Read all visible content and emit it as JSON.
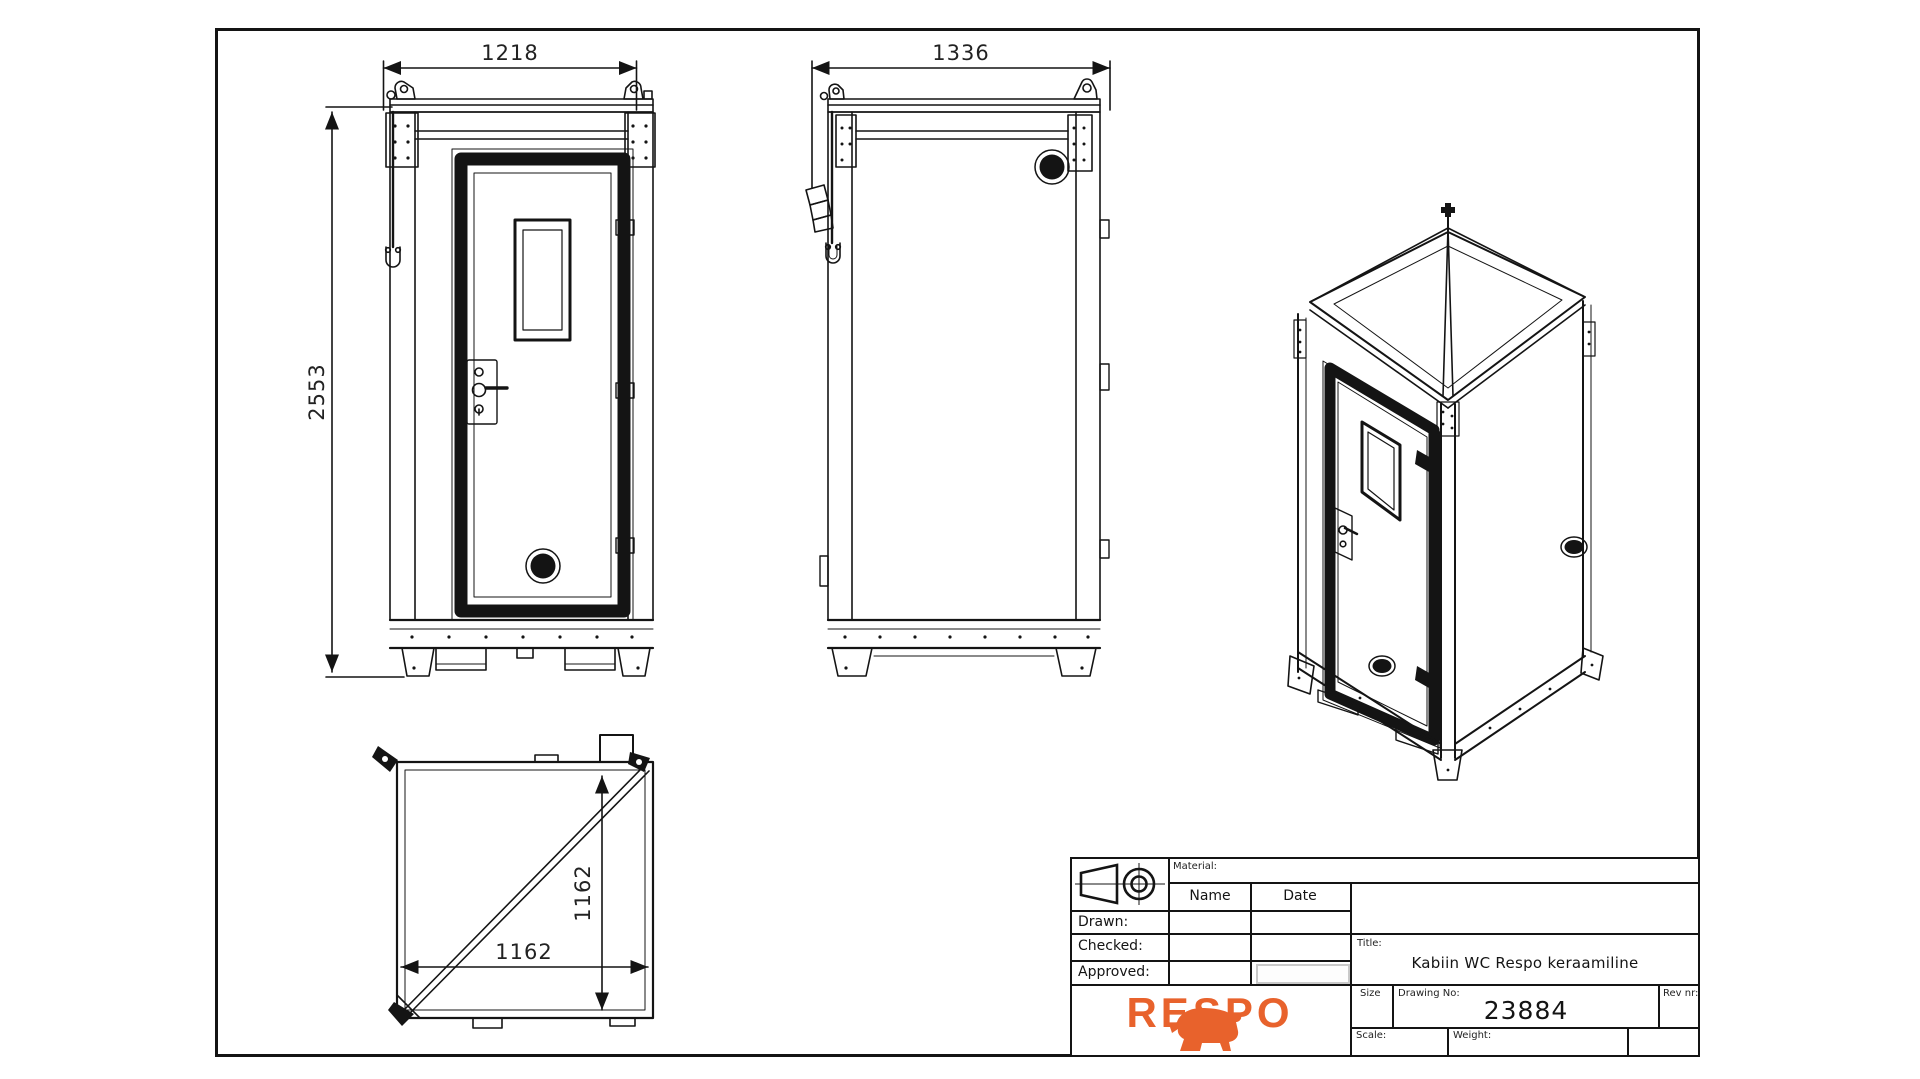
{
  "views": {
    "front": {
      "label": "front-view",
      "width_dim": "1218",
      "height_dim": "2553"
    },
    "side": {
      "label": "side-view",
      "width_dim": "1336"
    },
    "top": {
      "label": "top-view",
      "width_dim": "1162",
      "depth_dim": "1162"
    },
    "iso": {
      "label": "isometric-view"
    }
  },
  "title_block": {
    "material_label": "Material:",
    "name_header": "Name",
    "date_header": "Date",
    "drawn_label": "Drawn:",
    "checked_label": "Checked:",
    "approved_label": "Approved:",
    "title_label": "Title:",
    "title": "Kabiin WC Respo keraamiline",
    "size_label": "Size",
    "drawing_no_label": "Drawing No:",
    "drawing_no": "23884",
    "rev_label": "Rev nr:",
    "scale_label": "Scale:",
    "weight_label": "Weight:",
    "logo": "RESPO",
    "logo_color": "#e8622c",
    "line_color": "#141414"
  }
}
